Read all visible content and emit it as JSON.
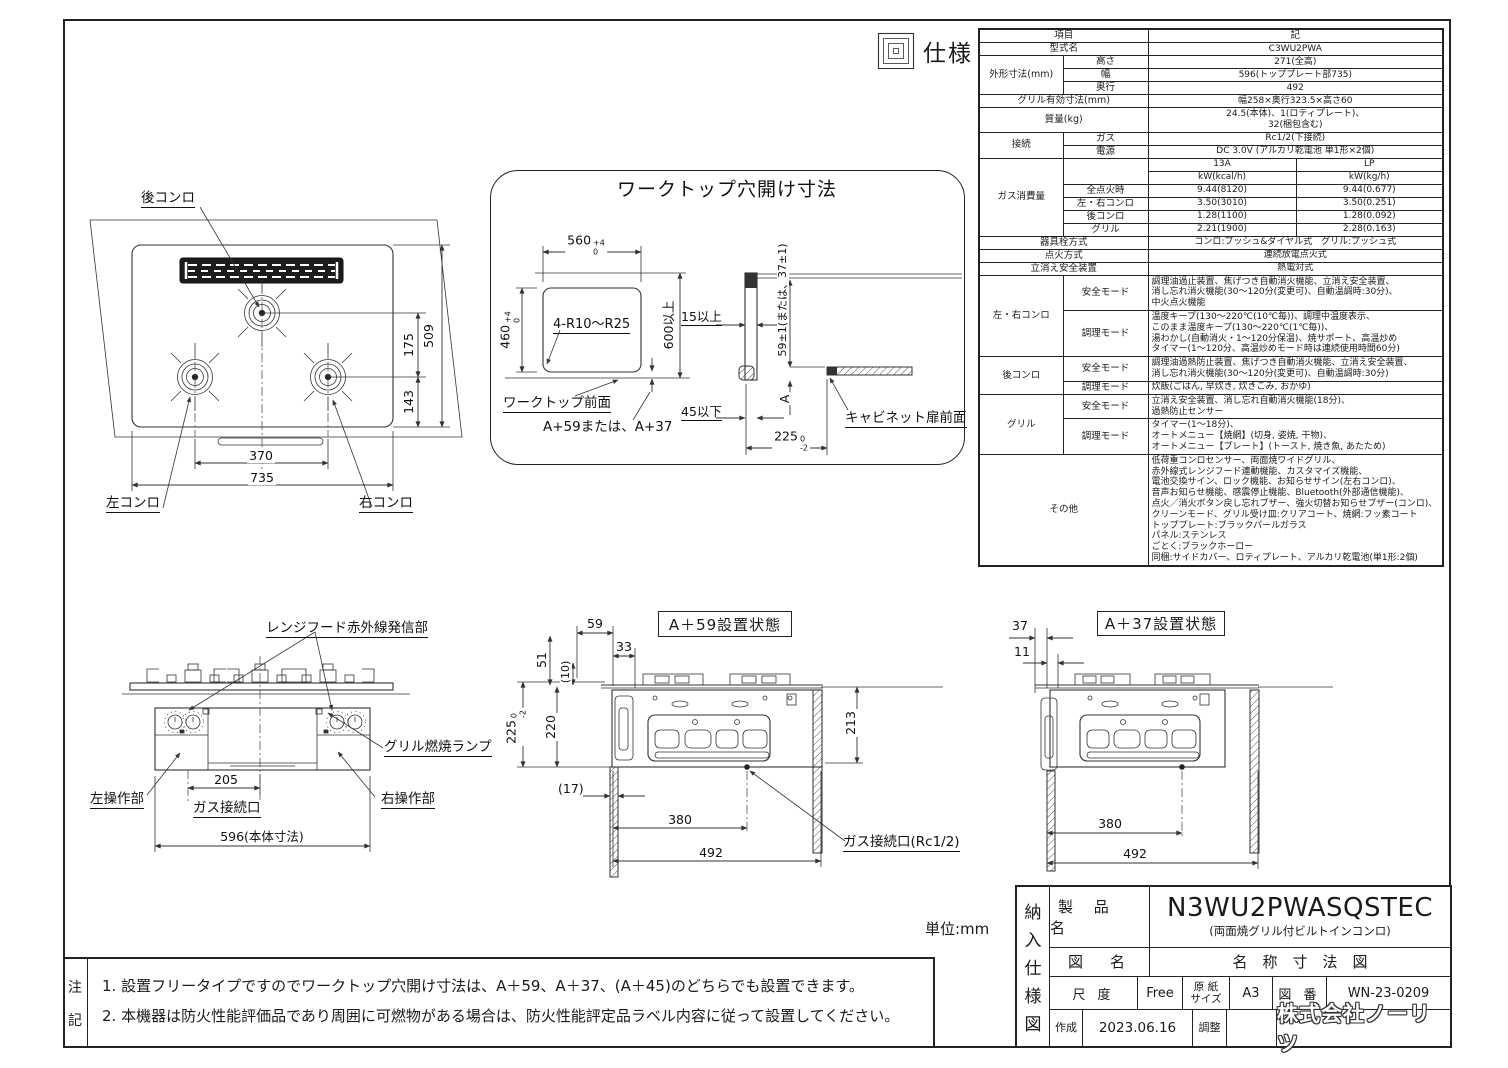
{
  "page": {
    "spec_section_label": "仕様",
    "unit_note": "単位:mm"
  },
  "top_view": {
    "rear_burner_label": "後コンロ",
    "left_burner_label": "左コンロ",
    "right_burner_label": "右コンロ",
    "dim_175": "175",
    "dim_509": "509",
    "dim_143": "143",
    "dim_370": "370",
    "dim_735": "735"
  },
  "worktop_panel": {
    "title": "ワークトップ穴開け寸法",
    "dim_560": "560",
    "dim_560_tol_plus": "+4",
    "dim_560_tol_minus": "0",
    "dim_460": "460",
    "dim_460_tol_plus": "+4",
    "dim_460_tol_minus": "0",
    "corner_note": "4-R10～R25",
    "dim_600": "600以上",
    "dim_15": "15以上",
    "dim_59": "59±1(または、37±1)",
    "front_label": "ワークトップ前面",
    "a_note": "A+59または、A+37",
    "dim_45": "45以下",
    "dim_A": "A",
    "cabinet_label": "キャビネット扉前面",
    "dim_225": "225",
    "dim_225_tol_plus": "0",
    "dim_225_tol_minus": "-2"
  },
  "front_view": {
    "hood_label": "レンジフード赤外線発信部",
    "grill_lamp_label": "グリル燃焼ランプ",
    "left_panel_label": "左操作部",
    "right_panel_label": "右操作部",
    "gas_port_label": "ガス接続口",
    "dim_205": "205",
    "dim_596": "596(本体寸法)"
  },
  "a59_view": {
    "title": "A＋59設置状態",
    "dim_59": "59",
    "dim_51": "51",
    "dim_10": "(10)",
    "dim_33": "33",
    "dim_225": "225",
    "dim_225_tol_plus": "0",
    "dim_225_tol_minus": "-2",
    "dim_220": "220",
    "dim_213": "213",
    "dim_17": "(17)",
    "dim_380": "380",
    "dim_492": "492",
    "gas_port_label": "ガス接続口(Rc1/2)"
  },
  "a37_view": {
    "title": "A＋37設置状態",
    "dim_37": "37",
    "dim_11": "11",
    "dim_380": "380",
    "dim_492": "492"
  },
  "spec_table": {
    "header_item": "項目",
    "header_value": "記",
    "model_label": "型式名",
    "model_value": "C3WU2PWA",
    "outer_label": "外形寸法(mm)",
    "outer_rows": [
      {
        "k": "高さ",
        "v": "271(全高)"
      },
      {
        "k": "幅",
        "v": "596(トッププレート部735)"
      },
      {
        "k": "奥行",
        "v": "492"
      }
    ],
    "grill_size_label": "グリル有効寸法(mm)",
    "grill_size_value": "幅258×奥行323.5×高さ60",
    "weight_label": "質量(kg)",
    "weight_value": "24.5(本体)、1(ロティプレート)、\n32(梱包含む)",
    "conn_label": "接続",
    "conn_rows": [
      {
        "k": "ガス",
        "v": "Rc1/2(下接続)"
      },
      {
        "k": "電源",
        "v": "DC 3.0V (アルカリ乾電池 単1形×2個)"
      }
    ],
    "gas_label": "ガス消費量",
    "gas_col1": "13A",
    "gas_col2": "LP",
    "gas_unit1": "kW(kcal/h)",
    "gas_unit2": "kW(kg/h)",
    "gas_rows": [
      {
        "k": "全点火時",
        "v1": "9.44(8120)",
        "v2": "9.44(0.677)"
      },
      {
        "k": "左・右コンロ",
        "v1": "3.50(3010)",
        "v2": "3.50(0.251)"
      },
      {
        "k": "後コンロ",
        "v1": "1.28(1100)",
        "v2": "1.28(0.092)"
      },
      {
        "k": "グリル",
        "v1": "2.21(1900)",
        "v2": "2.28(0.163)"
      }
    ],
    "valve_label": "器具栓方式",
    "valve_value": "コンロ:プッシュ&ダイヤル式　グリル:プッシュ式",
    "ignition_label": "点火方式",
    "ignition_value": "連続放電点火式",
    "flameout_label": "立消え安全装置",
    "flameout_value": "熱電対式",
    "safe_mode_label": "安全モード",
    "cook_mode_label": "調理モード",
    "lr_label": "左・右コンロ",
    "lr_safe": "調理油過止装置、焦げつき自動消火機能、立消え安全装置、\n消し忘れ消火機能(30～120分(変更可)、自動温調時:30分)、\n中火点火機能",
    "lr_cook": "温度キープ(130～220℃(10℃毎))、調理中温度表示、\nこのまま温度キープ(130～220℃(1℃毎))、\n湯わかし(自動消火・1～120分保温)、焼サポート、高温炒め\nタイマー(1～120分、高温炒めモード時は連続使用時間60分)",
    "rear_label": "後コンロ",
    "rear_safe": "調理油過熱防止装置、焦げつき自動消火機能、立消え安全装置、\n消し忘れ消火機能(30～120分(変更可)、自動温調時:30分)",
    "rear_cook": "炊飯(ごはん, 早炊き, 炊きこみ, おかゆ)",
    "grill_label": "グリル",
    "grill_safe": "立消え安全装置、消し忘れ自動消火機能(18分)、\n過熱防止センサー",
    "grill_cook": "タイマー(1～18分)、\nオートメニュー【焼網】(切身, 姿焼, 干物)、\nオートメニュー【プレート】(トースト, 焼き魚, あたため)",
    "other_label": "その他",
    "other_value": "低荷重コンロセンサー、両面焼ワイドグリル、\n赤外線式レンジフード連動機能、カスタマイズ機能、\n電池交換サイン、ロック機能、お知らせサイン(左右コンロ)、\n音声お知らせ機能、感震停止機能、Bluetooth(外部通信機能)、\n点火／消火ボタン戻し忘れブザー、強火切替お知らせブザー(コンロ)、\nクリーンモード、グリル受け皿:クリアコート、焼網:フッ素コート\nトッププレート:ブラックパールガラス\nパネル:ステンレス\nごとく:ブラックホーロー\n同梱:サイドカバー、ロティプレート、アルカリ乾電池(単1形:2個)"
  },
  "notes": {
    "label_1": "注",
    "label_2": "記",
    "line1": "1. 設置フリータイプですのでワークトップ穴開け寸法は、A＋59、A＋37、(A＋45)のどちらでも設置できます。",
    "line2": "2. 本機器は防火性能評価品であり周囲に可燃物がある場合は、防火性能評定品ラベル内容に従って設置してください。"
  },
  "title_block": {
    "doc_type_chars": [
      "納",
      "入",
      "仕",
      "様",
      "図"
    ],
    "product_label": "製 品 名",
    "product_name": "N3WU2PWASQSTEC",
    "product_subtitle": "(両面焼グリル付ビルトインコンロ)",
    "drawing_label": "図　名",
    "drawing_name": "名　称　寸　法　図",
    "scale_label": "尺 度",
    "scale_value": "Free",
    "paper_label": "原 紙\nサイズ",
    "paper_value": "A3",
    "number_label": "図 番",
    "number_value": "WN-23-0209",
    "created_label": "作成",
    "created_value": "2023.06.16",
    "adjust_label": "調整",
    "company": "株式会社ノーリツ"
  }
}
